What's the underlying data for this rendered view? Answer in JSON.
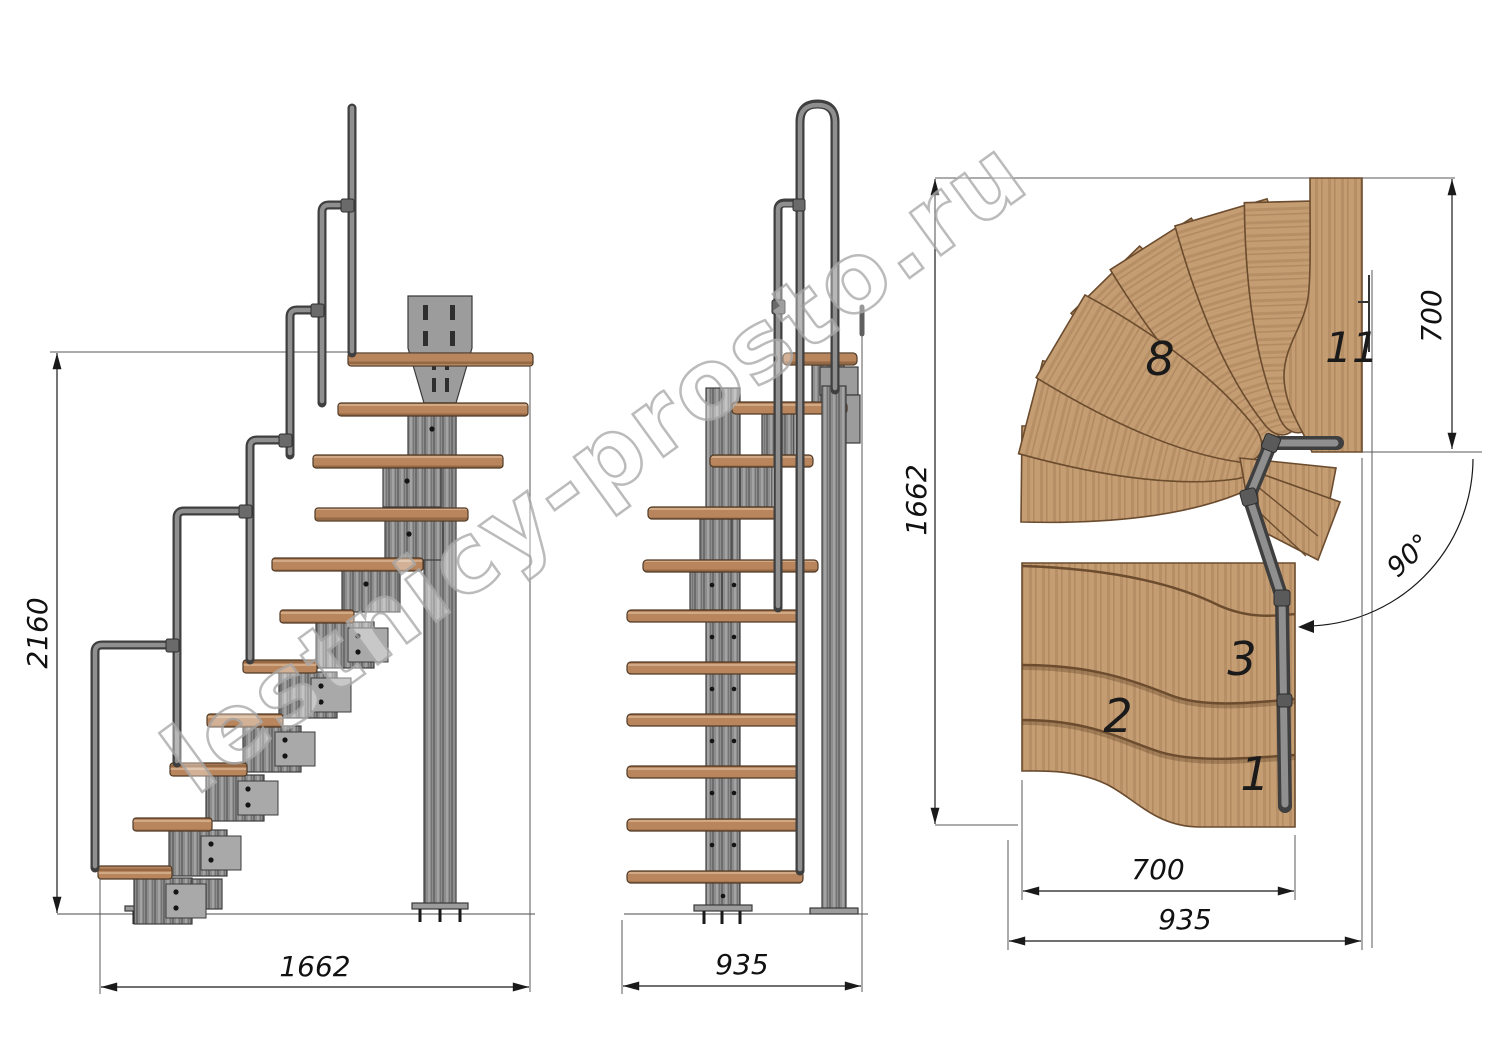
{
  "watermark": {
    "text": "lestnicy-prosto.ru"
  },
  "side_view": {
    "height_label": "2160",
    "run_label": "1662"
  },
  "front_view": {
    "width_label": "935"
  },
  "plan_view": {
    "depth_label": "1662",
    "landing_depth_label": "700",
    "flight_width_label": "700",
    "overall_width_label": "935",
    "angle_label": "90°",
    "tread_numbers": {
      "t1": "1",
      "t2": "2",
      "t3": "3",
      "t8": "8",
      "t11": "11"
    }
  },
  "colors": {
    "background": "#ffffff",
    "wood": "#c59d73",
    "wood_dark_edge": "#6b4c2e",
    "wood_side": "#b9855c",
    "metal": "#8d8d8d",
    "metal_dark": "#3c3c3c",
    "dimension_line": "#1a1a1a",
    "watermark_outline": "#ababab"
  }
}
